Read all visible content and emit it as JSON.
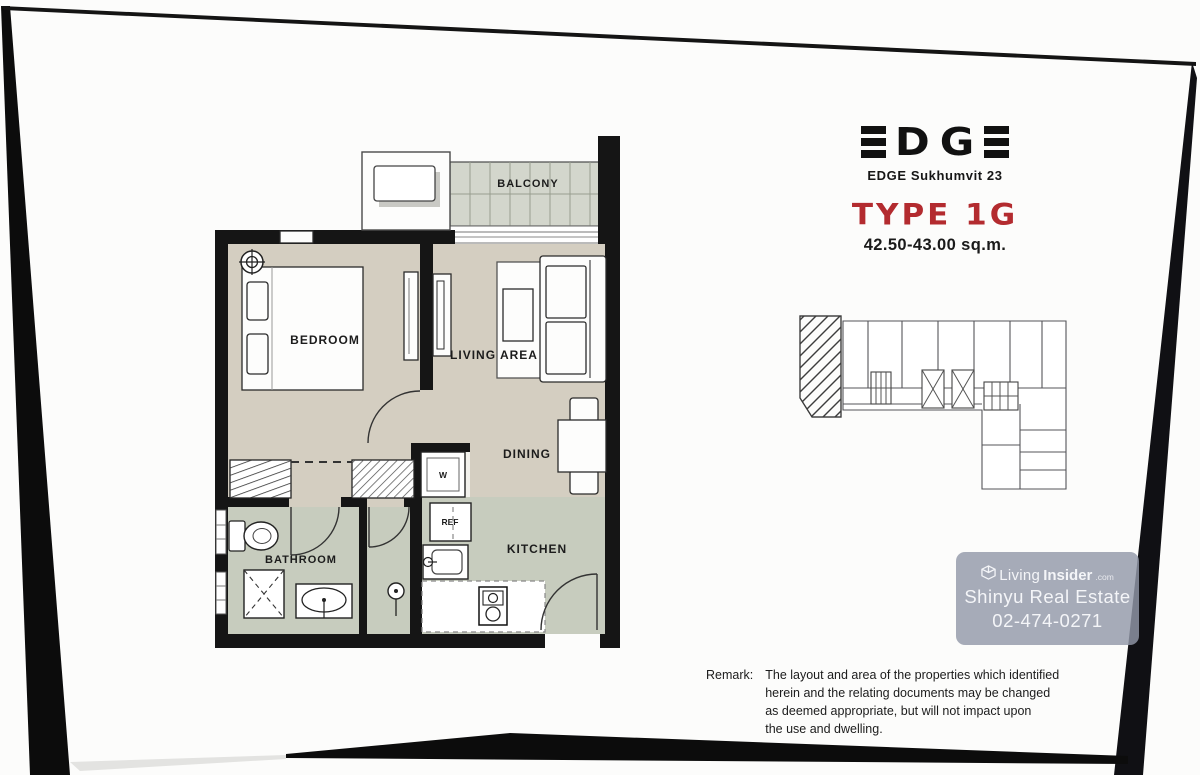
{
  "branding": {
    "logo_d": "D",
    "logo_g": "G",
    "project": "EDGE Sukhumvit 23",
    "type_title": "TYPE 1G",
    "area": "42.50-43.00 sq.m."
  },
  "plan_labels": {
    "balcony": "BALCONY",
    "bedroom": "BEDROOM",
    "living": "LIVING AREA",
    "dining": "DINING",
    "kitchen": "KITCHEN",
    "bathroom": "BATHROOM",
    "washer": "W",
    "fridge": "REF"
  },
  "watermark": {
    "brand_a": "Living",
    "brand_b": "Insider",
    "brand_tld": ".com",
    "agency": "Shinyu Real Estate",
    "phone": "02-474-0271"
  },
  "remark": {
    "label": "Remark:",
    "line1": "The layout and area of the properties which identified",
    "line2": "herein and the relating documents may be changed",
    "line3": "as deemed appropriate, but will not impact upon",
    "line4": "the use and dwelling."
  },
  "colors": {
    "accent_red": "#b32b2f",
    "wall": "#151515",
    "floor_dry": "#d4cec1",
    "floor_wet": "#c7ccbe",
    "floor_balcony": "#d3d6cc"
  }
}
